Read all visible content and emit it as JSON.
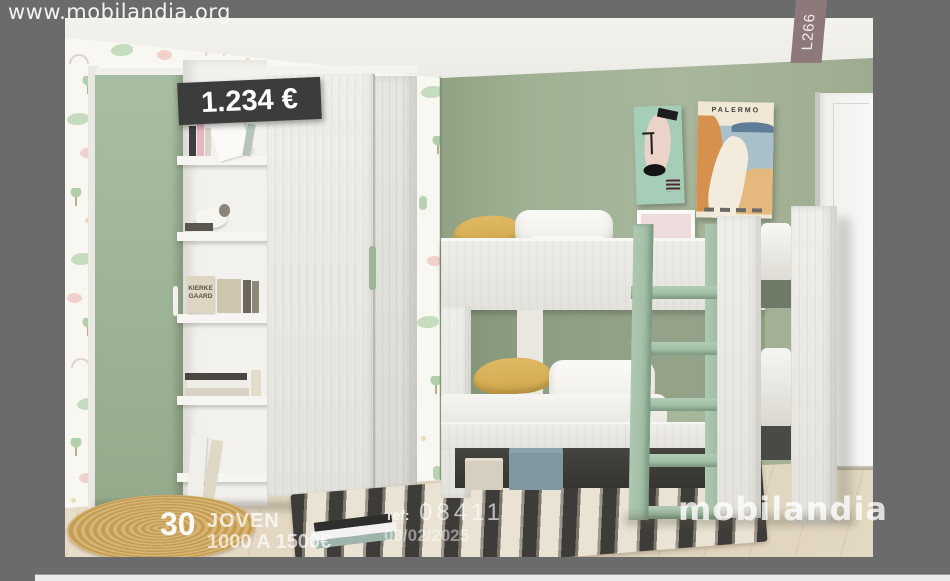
{
  "app": {
    "site_url": "www.mobilandia.org",
    "page_tab_label": "L266",
    "background_color": "#6b6b6b"
  },
  "annotations": {
    "price_tag": "1.234 €",
    "page_number": "30",
    "category": "JOVEN",
    "price_range": "1000 A 1500€",
    "ref_label": "ref:",
    "ref_value": "08411",
    "date": "08/02/2025",
    "watermark": "mobilandia"
  },
  "scene": {
    "palermo_poster_title": "PALERMO",
    "book_cover_text": "KIERKE GAARD",
    "accent_green": "#9cb394",
    "pillow_yellow": "#d9b159",
    "tag_background": "#3c3c3c",
    "tab_background": "#8d797a"
  }
}
